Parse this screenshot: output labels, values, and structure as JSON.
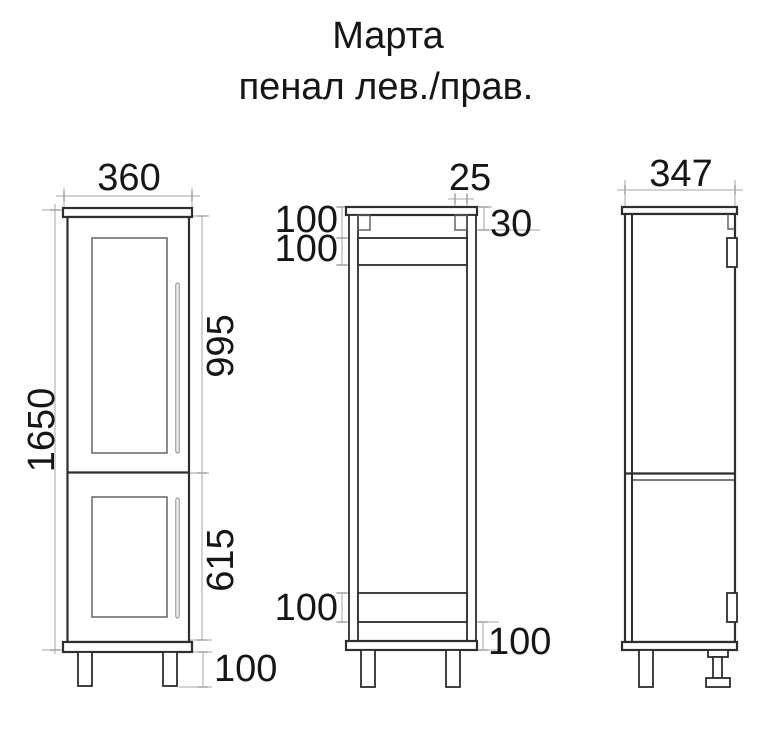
{
  "title": {
    "line1": "Марта",
    "line2": "пенал лев./прав."
  },
  "front_view": {
    "width_mm": "360",
    "total_height_mm": "1650",
    "upper_door_mm": "995",
    "lower_door_mm": "615",
    "leg_height_mm": "100"
  },
  "section_view": {
    "top_cleat_width_mm": "25",
    "top_cleat_height_mm": "30",
    "top_rail_offset_mm": "100",
    "top_rail_height_mm": "100",
    "bottom_rail_height_mm": "100",
    "bottom_rail_offset_mm": "100"
  },
  "side_view": {
    "depth_mm": "347"
  },
  "colors": {
    "outline": "#2e2e2e",
    "dimension_line": "#a6a6a6",
    "rail_fill": "#a9a9a9",
    "hinge_fill": "#4f4f4f",
    "text": "#161616",
    "background": "#ffffff"
  }
}
